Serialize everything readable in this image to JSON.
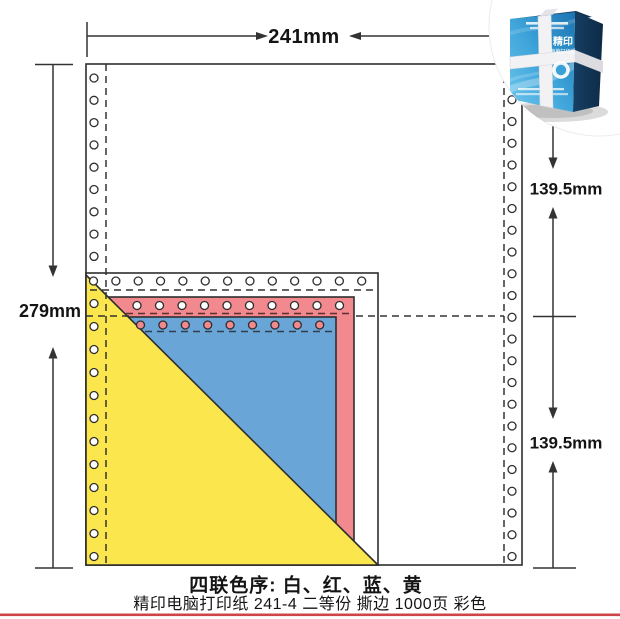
{
  "dimensions": {
    "width": "241mm",
    "height": "279mm",
    "half_top": "139.5mm",
    "half_bottom": "139.5mm"
  },
  "caption": {
    "color_order": "四联色序: 白、红、蓝、黄",
    "spec": "精印电脑打印纸 241-4 二等份 撕边 1000页 彩色"
  },
  "product_photo": {
    "brand": "精印",
    "subtitle": "电脑打印纸"
  },
  "plies": [
    {
      "name": "白",
      "color": "#ffffff"
    },
    {
      "name": "红",
      "color": "#f1898e"
    },
    {
      "name": "蓝",
      "color": "#6aa5d7"
    },
    {
      "name": "黄",
      "color": "#fbe64e"
    }
  ],
  "colors": {
    "outline": "#2e2e2e",
    "dimension_line": "#333333",
    "hole_fill": "#ffffff",
    "blue_strip_hole_fill": "#f1898e",
    "accent_bottom_line": "#cf4449",
    "box_blue_light": "#5fc0ea",
    "box_blue_dark": "#1e7cba",
    "box_side_dark": "#123a5e"
  }
}
